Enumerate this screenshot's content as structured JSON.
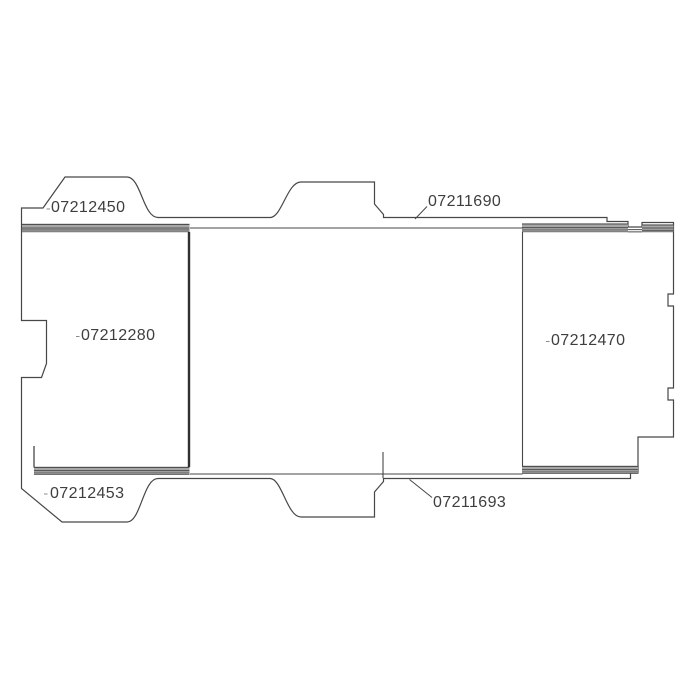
{
  "diagram": {
    "kind": "parts-line-drawing",
    "part_labels": [
      {
        "position": "top-left",
        "text": "07212450"
      },
      {
        "position": "top-right",
        "text": "07211690"
      },
      {
        "position": "left-panel",
        "text": "07212280"
      },
      {
        "position": "right-panel",
        "text": "07212470"
      },
      {
        "position": "bottom-left",
        "text": "07212453"
      },
      {
        "position": "bottom-right",
        "text": "07211693"
      }
    ],
    "colors": {
      "line": "#474747",
      "divider_line": "#303030",
      "stripe_gray": "#a7a7a7",
      "text": "#3e3e3e",
      "background": "#ffffff"
    }
  }
}
